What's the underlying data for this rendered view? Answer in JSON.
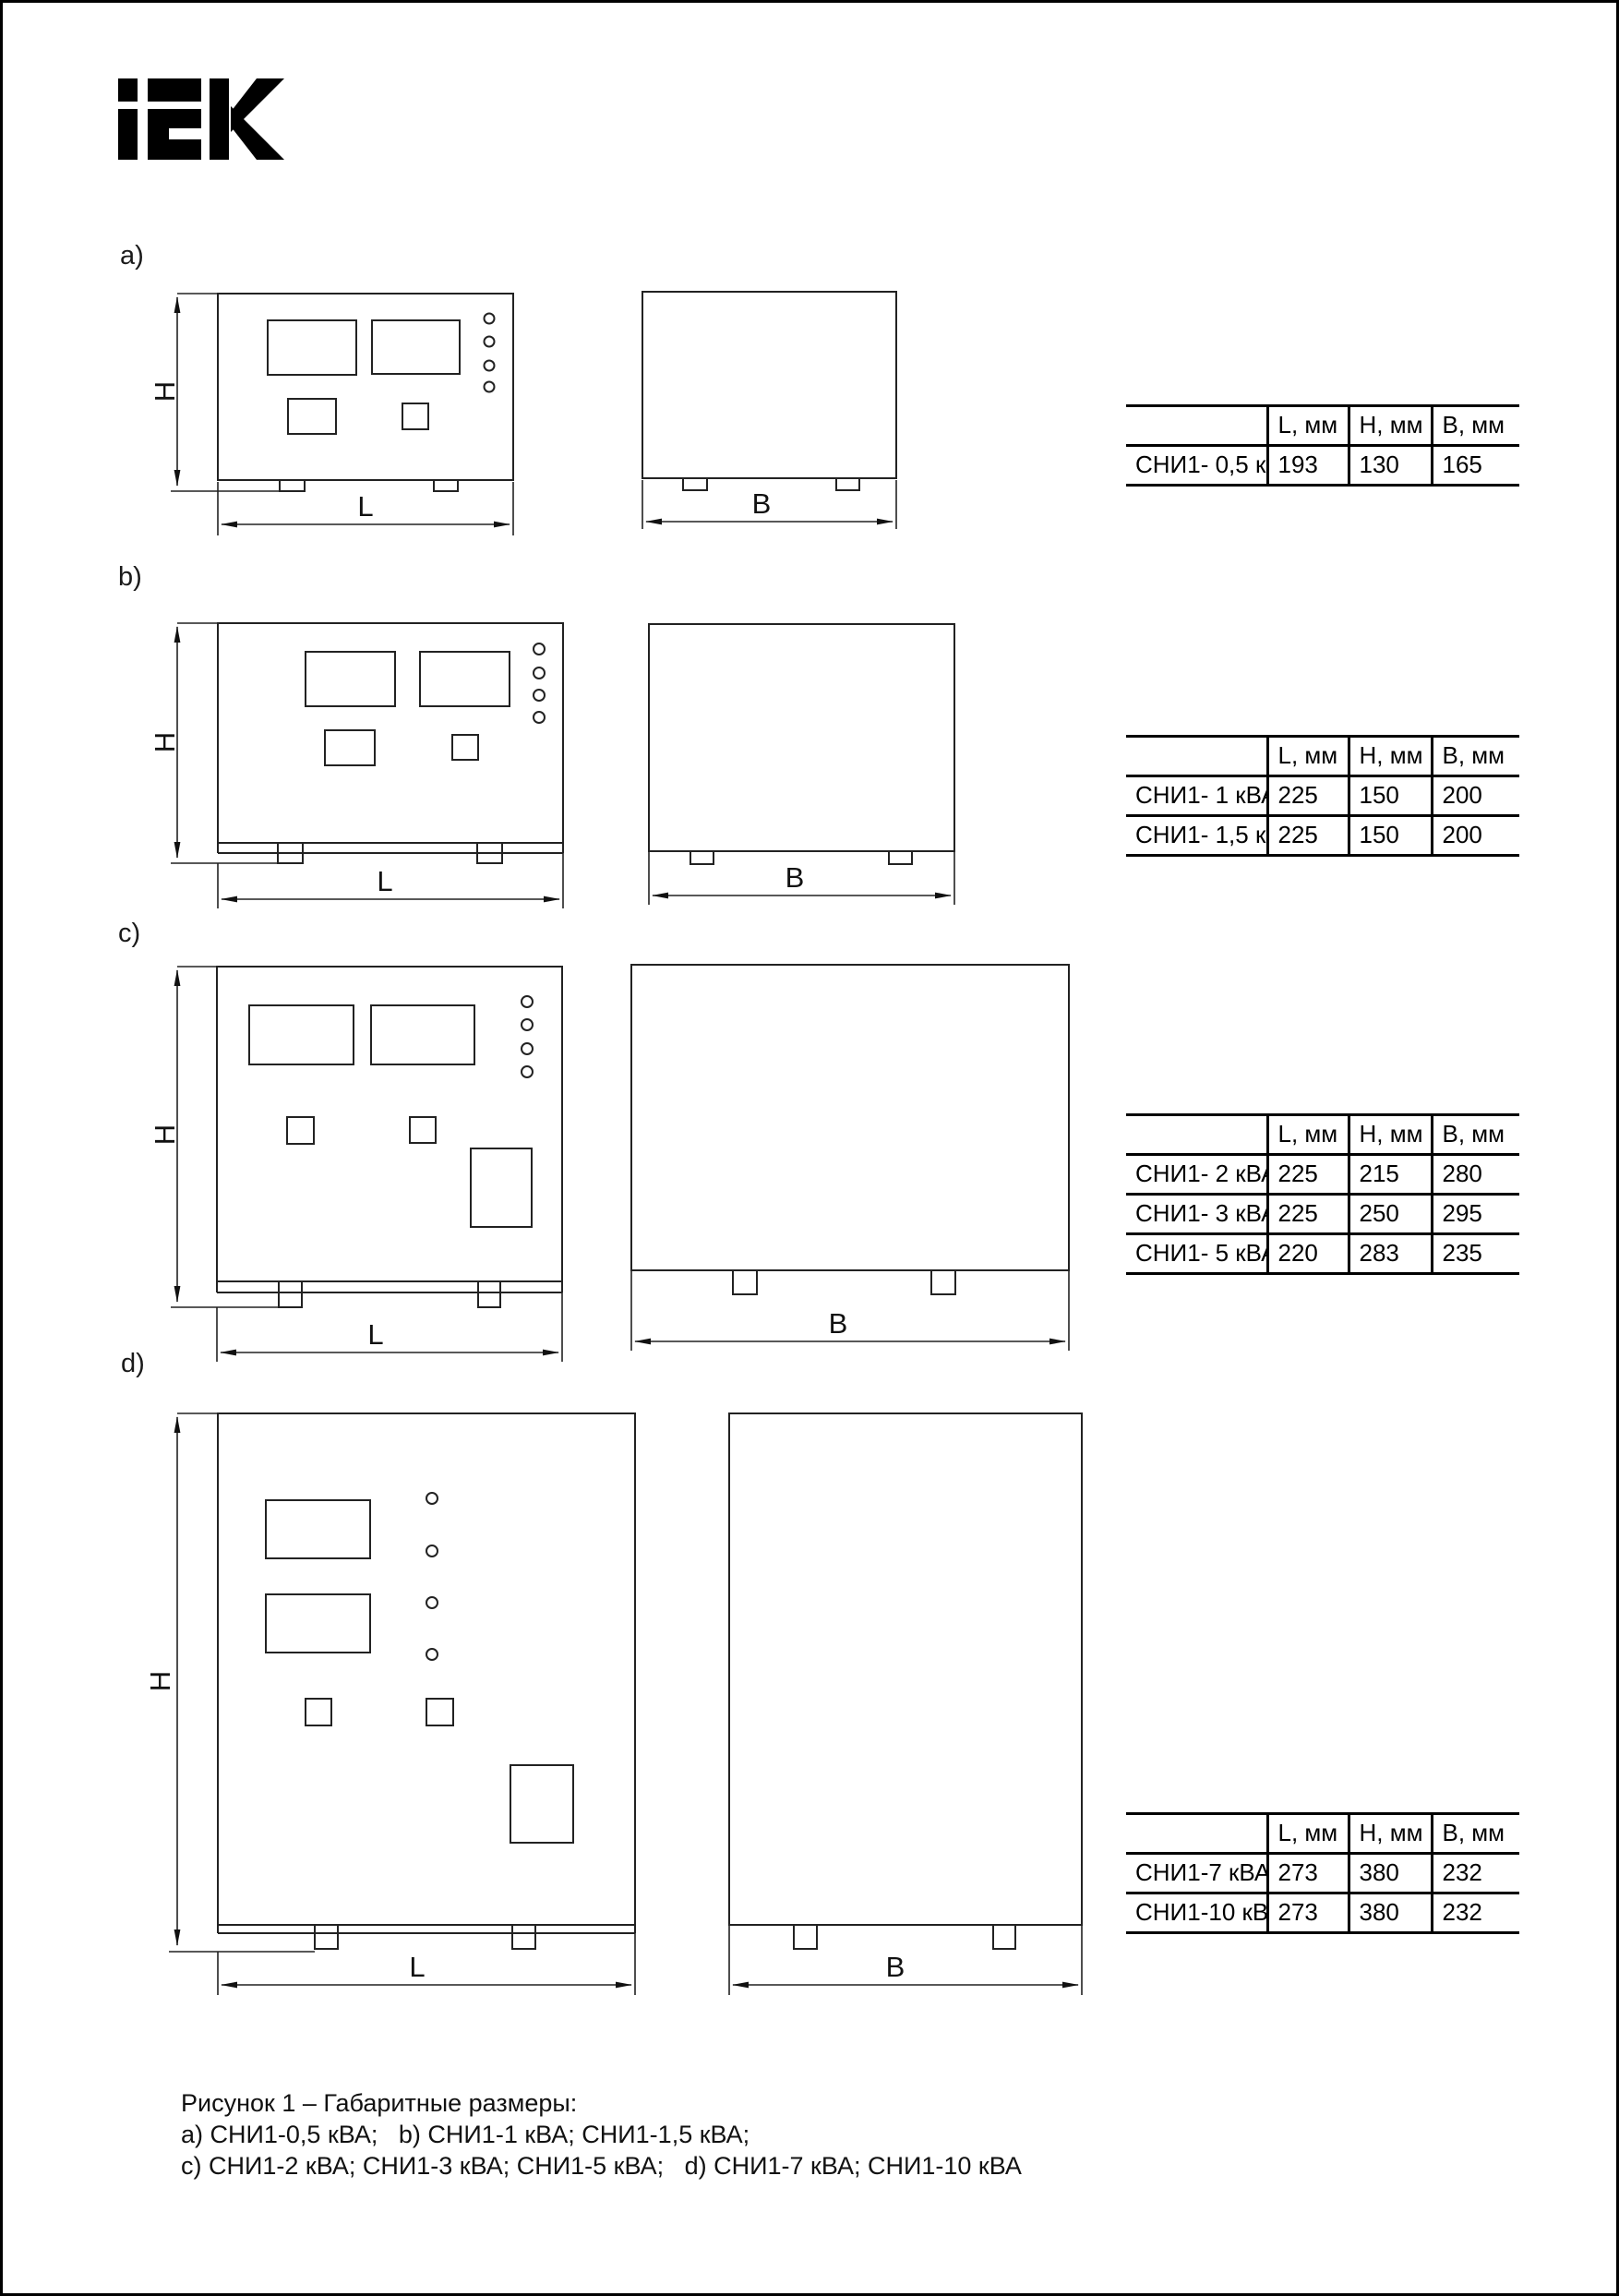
{
  "logo": {
    "name": "IEK"
  },
  "dims": {
    "h": "H",
    "l": "L",
    "b": "B"
  },
  "sections": [
    {
      "label": "a)",
      "table": {
        "col_headers": [
          "L, мм",
          "H, мм",
          "B, мм"
        ],
        "rows": [
          {
            "name": "СНИ1- 0,5 кВА",
            "l": "193",
            "h": "130",
            "b": "165"
          }
        ]
      }
    },
    {
      "label": "b)",
      "table": {
        "col_headers": [
          "L, мм",
          "H, мм",
          "B, мм"
        ],
        "rows": [
          {
            "name": "СНИ1- 1 кВА",
            "l": "225",
            "h": "150",
            "b": "200"
          },
          {
            "name": "СНИ1- 1,5 кВА",
            "l": "225",
            "h": "150",
            "b": "200"
          }
        ]
      }
    },
    {
      "label": "c)",
      "table": {
        "col_headers": [
          "L, мм",
          "H, мм",
          "B, мм"
        ],
        "rows": [
          {
            "name": "СНИ1- 2 кВА",
            "l": "225",
            "h": "215",
            "b": "280"
          },
          {
            "name": "СНИ1- 3 кВА",
            "l": "225",
            "h": "250",
            "b": "295"
          },
          {
            "name": "СНИ1- 5 кВА",
            "l": "220",
            "h": "283",
            "b": "235"
          }
        ]
      }
    },
    {
      "label": "d)",
      "table": {
        "col_headers": [
          "L, мм",
          "H, мм",
          "B, мм"
        ],
        "rows": [
          {
            "name": "СНИ1-7 кВА",
            "l": "273",
            "h": "380",
            "b": "232"
          },
          {
            "name": "СНИ1-10 кВА",
            "l": "273",
            "h": "380",
            "b": "232"
          }
        ]
      }
    }
  ],
  "caption": {
    "line1": "Рисунок 1 – Габаритные размеры:",
    "line2": "а) СНИ1-0,5 кВА;   b) СНИ1-1 кВА; СНИ1-1,5 кВА;",
    "line3": "c) СНИ1-2 кВА; СНИ1-3 кВА; СНИ1-5 кВА;   d) СНИ1-7 кВА; СНИ1-10 кВА"
  }
}
